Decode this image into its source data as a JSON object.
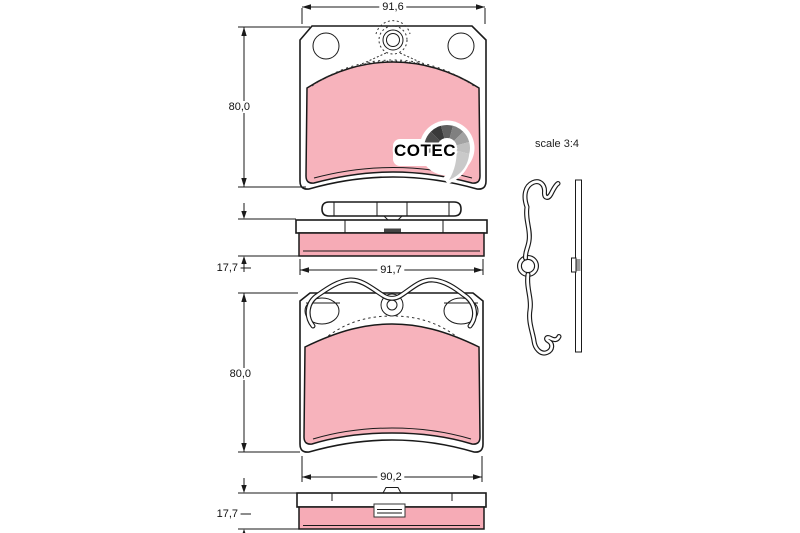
{
  "drawing": {
    "colors": {
      "background": "#ffffff",
      "line": "#1a1a1a",
      "pad_front": "#f7b3bc",
      "pad_side": "#f6abb6",
      "dashed": "#333333"
    },
    "labels": {
      "top_pad_width": "91,6",
      "top_pad_height": "80,0",
      "top_pad_thickness": "17,7",
      "middle_width": "91,7",
      "bottom_pad_height": "80,0",
      "bottom_pad_width": "90,2",
      "bottom_pad_thickness": "17,7",
      "scale_note": "scale 3:4"
    },
    "logo": {
      "text": "COTEC",
      "swirl_colors": [
        "#8c8c8c",
        "#4c4c4c",
        "#3a3a3a",
        "#5f5f5f",
        "#808080",
        "#a3a3a3",
        "#bfbfbf"
      ],
      "tail_color": "#c9c9c9"
    }
  }
}
